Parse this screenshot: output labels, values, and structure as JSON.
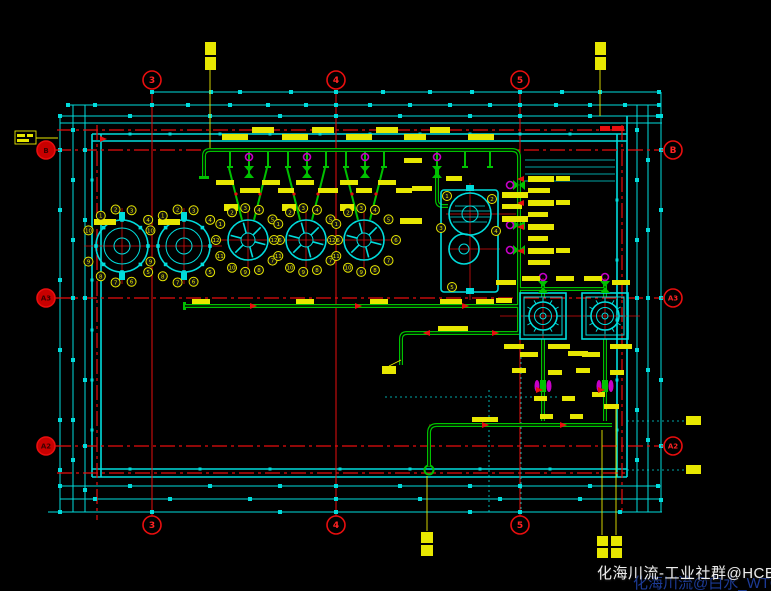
{
  "watermark": {
    "line1": "化海川流-工业社群@HCBBS",
    "line2": "化海川流@白水_WTGP"
  },
  "grid": {
    "top": [
      "3",
      "4",
      "5"
    ],
    "bottom": [
      "3",
      "4",
      "5"
    ],
    "left": [
      "B",
      "A3",
      "A2"
    ],
    "right": [
      "B",
      "A3",
      "A2"
    ]
  },
  "colors": {
    "background": "#000000",
    "construction_cyan": "#00dada",
    "grid_red": "#e01010",
    "label_yellow": "#e6e600",
    "pipe_green": "#00be00",
    "valve_magenta": "#c000c0",
    "watermark_white": "#ededed",
    "watermark_blue": "#1e3e9e"
  },
  "equipment": {
    "vessel1": {
      "callouts": [
        "1",
        "2",
        "3",
        "4",
        "5",
        "6",
        "7",
        "8",
        "9",
        "10"
      ]
    },
    "vessel2": {
      "callouts": [
        "1",
        "2",
        "3",
        "4",
        "5",
        "6",
        "7",
        "8",
        "9",
        "10"
      ]
    },
    "agitator1": {
      "callouts": [
        "1",
        "2",
        "3",
        "4",
        "5",
        "6",
        "7",
        "8",
        "9",
        "10",
        "11",
        "12"
      ]
    },
    "agitator2": {
      "callouts": [
        "1",
        "2",
        "3",
        "4",
        "5",
        "6",
        "7",
        "8",
        "9",
        "10",
        "11",
        "12"
      ]
    },
    "agitator3": {
      "callouts": [
        "1",
        "2",
        "3",
        "4",
        "5",
        "6",
        "7",
        "8",
        "9",
        "10",
        "11",
        "12"
      ]
    },
    "blower": {
      "callouts": [
        "1",
        "2",
        "3",
        "4",
        "5"
      ]
    }
  }
}
